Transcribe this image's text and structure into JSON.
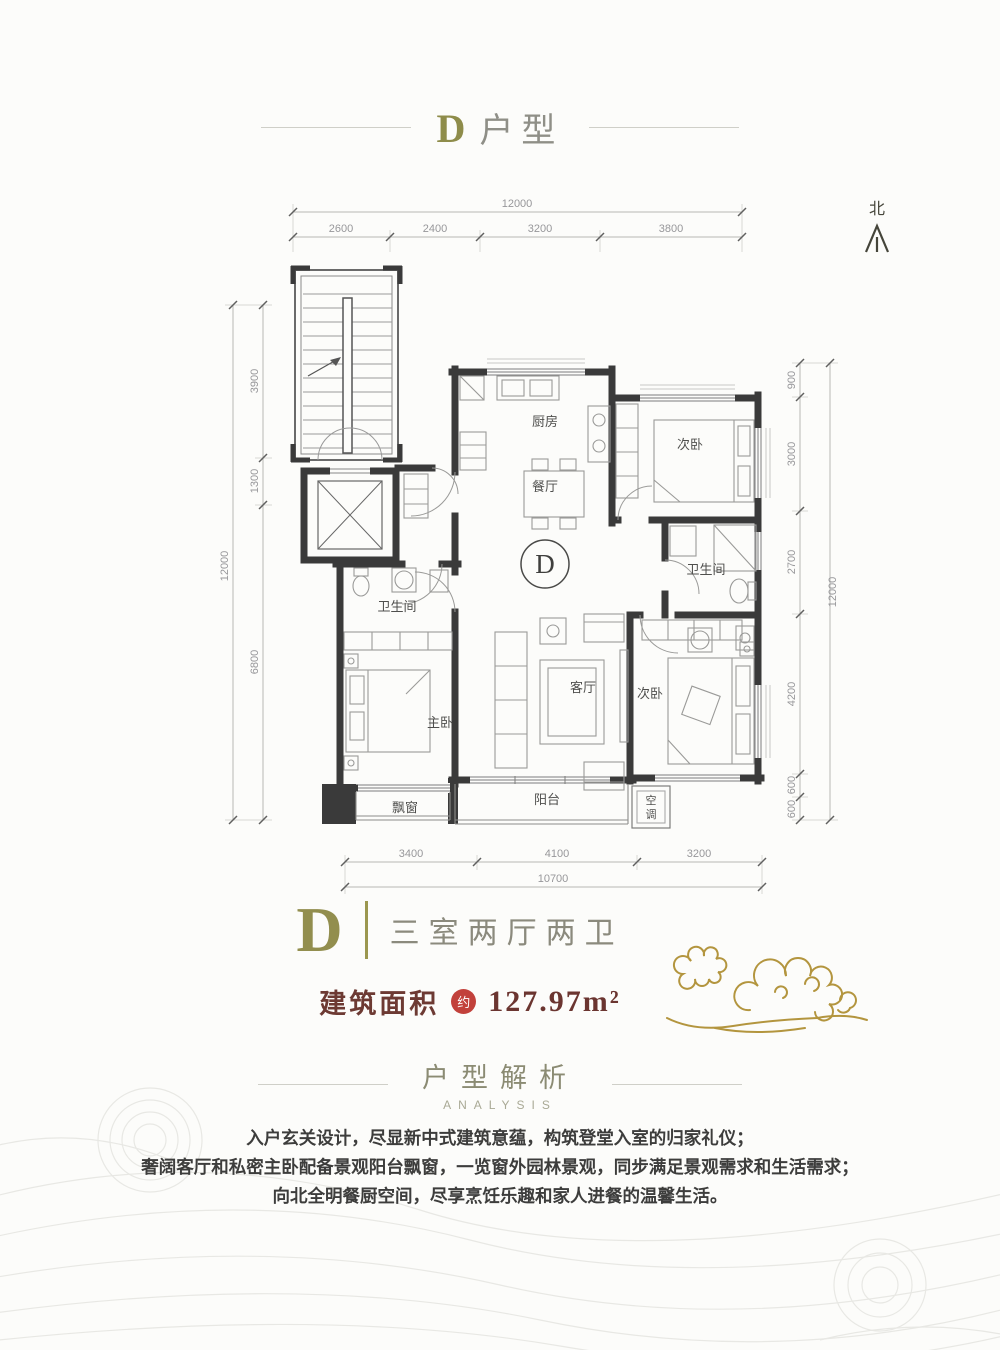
{
  "title": {
    "letter": "D",
    "text": "户型"
  },
  "north_label": "北",
  "dims": {
    "top": {
      "total": "12000",
      "segments": [
        "2600",
        "2400",
        "3200",
        "3800"
      ]
    },
    "left": {
      "total": "12000",
      "segments": [
        "3900",
        "1300",
        "6800"
      ]
    },
    "right": {
      "total": "12000",
      "segments": [
        "900",
        "3000",
        "2700",
        "4200",
        "600",
        "600"
      ]
    },
    "bottom": {
      "total": "10700",
      "segments": [
        "3400",
        "4100",
        "3200"
      ]
    }
  },
  "rooms": {
    "kitchen": "厨房",
    "dining": "餐厅",
    "bedroom_top": "次卧",
    "bath_right": "卫生间",
    "bath_left": "卫生间",
    "living": "客厅",
    "bedroom_bottom": "次卧",
    "master": "主卧",
    "balcony": "阳台",
    "bay_window": "飘窗",
    "ac_char1": "空",
    "ac_char2": "调",
    "unit_mark": "D"
  },
  "summary": {
    "letter": "D",
    "layout": "三室两厅两卫",
    "area_label": "建筑面积",
    "area_approx_seal": "约",
    "area_value": "127.97m²"
  },
  "analysis": {
    "heading": "户型解析",
    "subheading": "ANALYSIS",
    "lines": [
      "入户玄关设计，尽显新中式建筑意蕴，构筑登堂入室的归家礼仪；",
      "奢阔客厅和私密主卧配备景观阳台飘窗，一览窗外园林景观，同步满足景观需求和生活需求；",
      "向北全明餐厨空间，尽享烹饪乐趣和家人进餐的温馨生活。"
    ]
  }
}
